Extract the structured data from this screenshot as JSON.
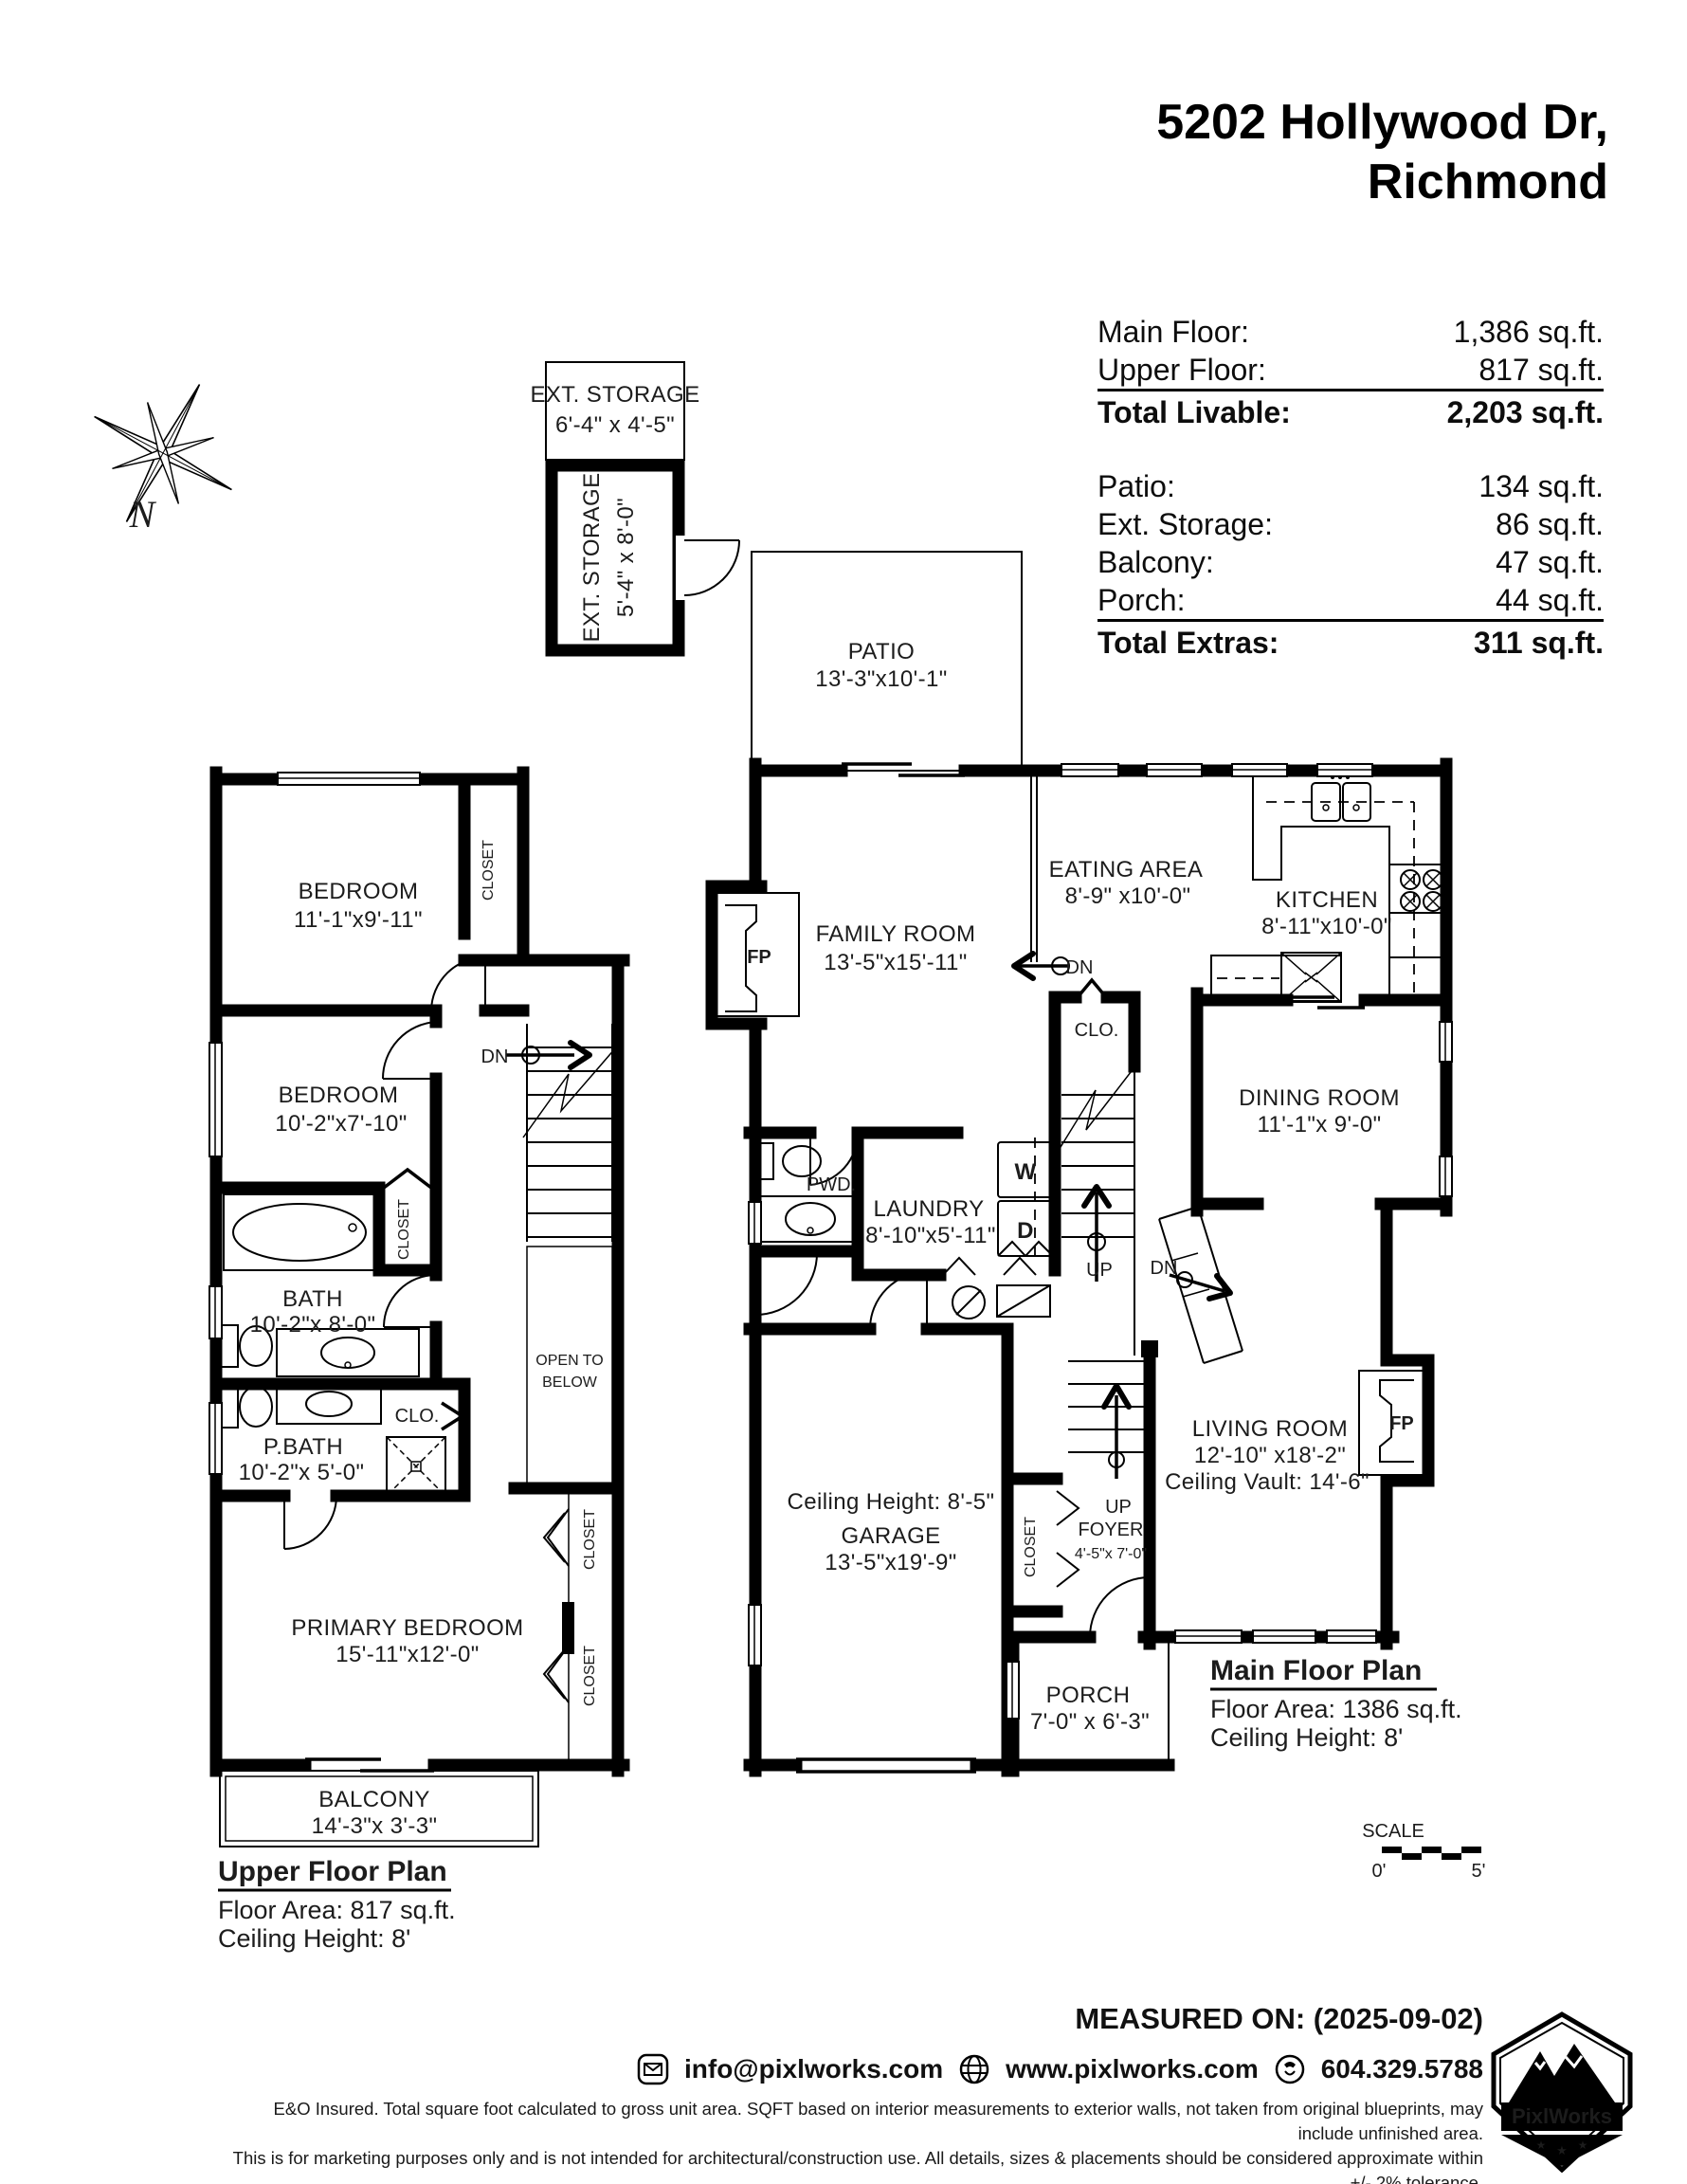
{
  "header": {
    "address_line1": "5202 Hollywood Dr,",
    "address_line2": "Richmond"
  },
  "area_summary": {
    "rows_livable": [
      {
        "label": "Main Floor:",
        "value": "1,386 sq.ft."
      },
      {
        "label": "Upper Floor:",
        "value": "817 sq.ft."
      }
    ],
    "total_livable": {
      "label": "Total Livable:",
      "value": "2,203 sq.ft."
    },
    "rows_extras": [
      {
        "label": "Patio:",
        "value": "134 sq.ft."
      },
      {
        "label": "Ext. Storage:",
        "value": "86 sq.ft."
      },
      {
        "label": "Balcony:",
        "value": "47 sq.ft."
      },
      {
        "label": "Porch:",
        "value": "44 sq.ft."
      }
    ],
    "total_extras": {
      "label": "Total Extras:",
      "value": "311 sq.ft."
    }
  },
  "compass": {
    "north": "N"
  },
  "ext_storage": {
    "upper_name": "EXT. STORAGE",
    "upper_dims": "6'-4\" x 4'-5\"",
    "lower_name": "EXT. STORAGE",
    "lower_dims": "5'-4\" x 8'-0\""
  },
  "upper_floor": {
    "rooms": {
      "bedroom1": {
        "name": "BEDROOM",
        "dims": "11'-1\"x9'-11\""
      },
      "bedroom2": {
        "name": "BEDROOM",
        "dims": "10'-2\"x7'-10\""
      },
      "bath": {
        "name": "BATH",
        "dims": "10'-2\"x 8'-0\""
      },
      "pbath": {
        "name": "P.BATH",
        "dims": "10'-2\"x 5'-0\""
      },
      "primary": {
        "name": "PRIMARY BEDROOM",
        "dims": "15'-11\"x12'-0\""
      },
      "balcony": {
        "name": "BALCONY",
        "dims": "14'-3\"x 3'-3\""
      }
    },
    "labels": {
      "closet1": "CLOSET",
      "closet2": "CLOSET",
      "closet3": "CLOSET",
      "closet4": "CLOSET",
      "clo": "CLO.",
      "dn": "DN",
      "open_to_below_1": "OPEN TO",
      "open_to_below_2": "BELOW"
    },
    "title": "Upper Floor Plan",
    "floor_area": "Floor Area: 817 sq.ft.",
    "ceiling": "Ceiling Height: 8'"
  },
  "main_floor": {
    "rooms": {
      "patio": {
        "name": "PATIO",
        "dims": "13'-3\"x10'-1\""
      },
      "family": {
        "name": "FAMILY ROOM",
        "dims": "13'-5\"x15'-11\""
      },
      "eating": {
        "name": "EATING AREA",
        "dims": "8'-9\" x10'-0\""
      },
      "kitchen": {
        "name": "KITCHEN",
        "dims": "8'-11\"x10'-0\""
      },
      "dining": {
        "name": "DINING ROOM",
        "dims": "11'-1\"x 9'-0\""
      },
      "laundry": {
        "name": "LAUNDRY",
        "dims": "8'-10\"x5'-11\""
      },
      "living": {
        "name": "LIVING ROOM",
        "dims": "12'-10\" x18'-2\"",
        "note": "Ceiling Vault: 14'-6\""
      },
      "garage": {
        "note": "Ceiling Height: 8'-5\"",
        "name": "GARAGE",
        "dims": "13'-5\"x19'-9\""
      },
      "foyer": {
        "name": "FOYER",
        "dims": "4'-5\"x 7'-0\""
      },
      "porch": {
        "name": "PORCH",
        "dims": "7'-0\" x 6'-3\""
      }
    },
    "labels": {
      "pwd": "PWD.",
      "washer": "W",
      "dryer": "D",
      "fp_family": "FP",
      "fp_living": "FP",
      "clo": "CLO.",
      "closet": "CLOSET",
      "dn1": "DN",
      "dn2": "DN",
      "up1": "UP",
      "up2": "UP"
    },
    "title": "Main Floor Plan",
    "floor_area": "Floor Area: 1386 sq.ft.",
    "ceiling": "Ceiling Height: 8'"
  },
  "scale_bar": {
    "label": "SCALE",
    "start": "0'",
    "end": "5'"
  },
  "footer": {
    "measured_on": "MEASURED ON: (2025-09-02)",
    "email": "info@pixlworks.com",
    "website": "www.pixlworks.com",
    "phone": "604.329.5788",
    "disclaimer1": "E&O Insured.  Total square foot calculated to gross unit area. SQFT based on interior measurements to exterior walls, not taken from original blueprints, may include unfinished area.",
    "disclaimer2": "This is for marketing purposes only and is not intended for architectural/construction use.  All details, sizes & placements should be considered approximate within +/- 2%  tolerance.",
    "logo_name": "PixlWorks"
  }
}
